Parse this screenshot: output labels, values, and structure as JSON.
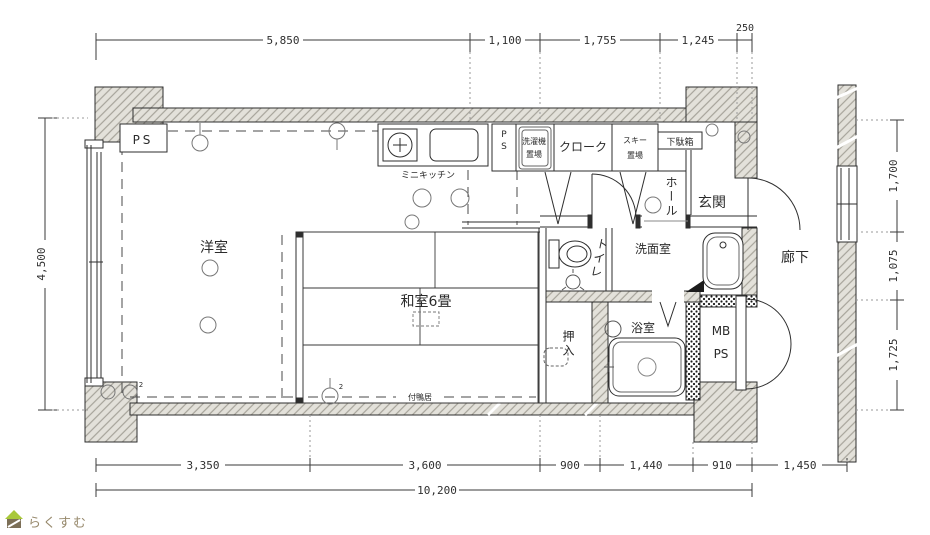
{
  "plan": {
    "rooms": {
      "ps_top": "PS",
      "mini_kitchen": "ミニキッチン",
      "ps_vert": "PS",
      "laundry_line1": "洗濯機",
      "laundry_line2": "置場",
      "cloak": "クローク",
      "ski_line1": "スキー",
      "ski_line2": "置場",
      "getabako": "下駄箱",
      "hall": "ホール",
      "genkan": "玄関",
      "western_room": "洋室",
      "japanese_room": "和室6畳",
      "tsukegamoi": "付鴨居",
      "toilet": "トイレ",
      "washroom": "洗面室",
      "corridor": "廊下",
      "closet": "押入",
      "bathroom": "浴室",
      "mb": "MB",
      "ps_meter": "PS"
    },
    "symbols": {
      "superscript": "2"
    },
    "dimensions": {
      "top": [
        "5,850",
        "1,100",
        "1,755",
        "1,245",
        "250"
      ],
      "left": "4,500",
      "right": [
        "1,700",
        "1,075",
        "1,725"
      ],
      "bottom": [
        "3,350",
        "3,600",
        "900",
        "1,440",
        "910",
        "1,450"
      ],
      "total_width": "10,200"
    },
    "colors": {
      "wall_fill": "#e3e1da",
      "line": "#2e2e2e",
      "logo_roof": "#a9c83b",
      "logo_body": "#7c6f57",
      "logo_text": "#97896c"
    }
  },
  "logo": {
    "text": "らくすむ"
  }
}
